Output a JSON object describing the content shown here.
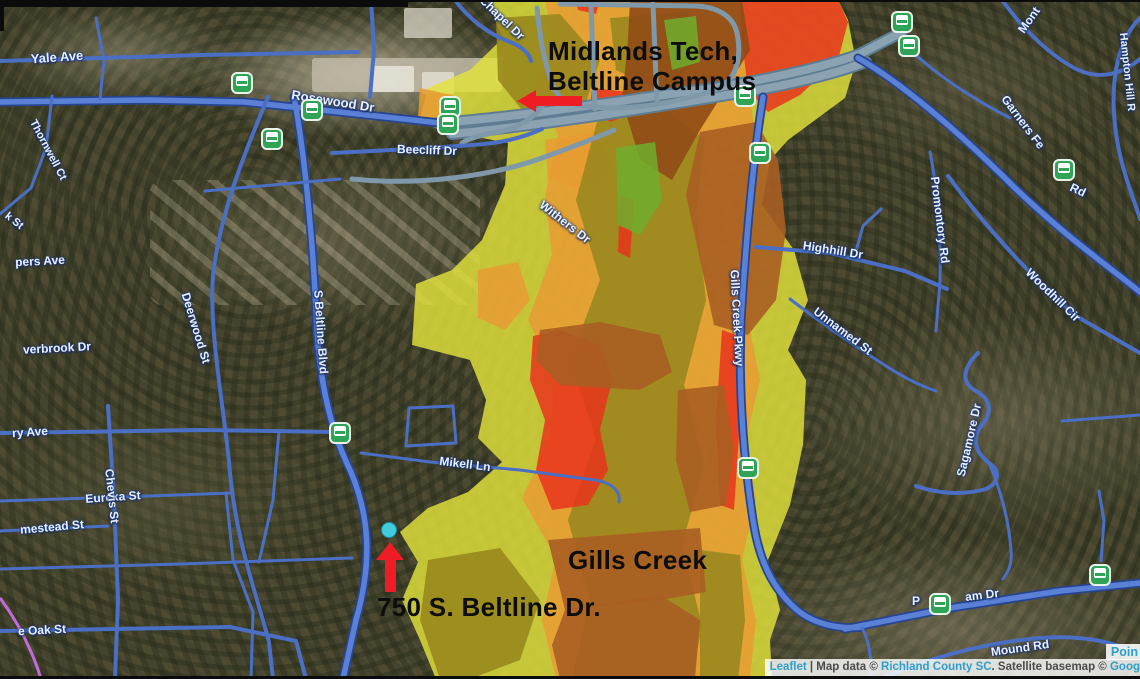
{
  "map": {
    "annotations": {
      "campus_line1": "Midlands Tech,",
      "campus_line2": "Beltline Campus",
      "address": "750 S. Beltline Dr.",
      "creek": "Gills Creek"
    },
    "street_labels": [
      {
        "text": "Yale Ave",
        "x": 57,
        "y": 57,
        "rot": -4,
        "size": 13
      },
      {
        "text": "Rosewood Dr",
        "x": 333,
        "y": 101,
        "rot": 9,
        "size": 13
      },
      {
        "text": "Thornwell Ct",
        "x": 48,
        "y": 150,
        "rot": 62,
        "size": 11
      },
      {
        "text": "Beecliff Dr",
        "x": 427,
        "y": 150,
        "rot": 2,
        "size": 12
      },
      {
        "text": "E Chapel Dr",
        "x": 498,
        "y": 14,
        "rot": 44,
        "size": 12
      },
      {
        "text": "k St",
        "x": 14,
        "y": 221,
        "rot": 38,
        "size": 11
      },
      {
        "text": "pers Ave",
        "x": 40,
        "y": 261,
        "rot": -3,
        "size": 12
      },
      {
        "text": "Withers Dr",
        "x": 565,
        "y": 222,
        "rot": 38,
        "size": 12
      },
      {
        "text": "Deerwood St",
        "x": 196,
        "y": 328,
        "rot": 73,
        "size": 12
      },
      {
        "text": "verbrook Dr",
        "x": 57,
        "y": 348,
        "rot": -3,
        "size": 12
      },
      {
        "text": "S Beltline Blvd",
        "x": 321,
        "y": 332,
        "rot": 86,
        "size": 12
      },
      {
        "text": "ry Ave",
        "x": 30,
        "y": 432,
        "rot": -4,
        "size": 12
      },
      {
        "text": "Eureka St",
        "x": 113,
        "y": 497,
        "rot": -4,
        "size": 12
      },
      {
        "text": "Chevis St",
        "x": 112,
        "y": 496,
        "rot": 84,
        "size": 12
      },
      {
        "text": "mestead St",
        "x": 52,
        "y": 527,
        "rot": -5,
        "size": 12
      },
      {
        "text": "e Oak St",
        "x": 42,
        "y": 630,
        "rot": -3,
        "size": 12
      },
      {
        "text": "Mikell Ln",
        "x": 465,
        "y": 464,
        "rot": 7,
        "size": 12
      },
      {
        "text": "Gills Creek Pkwy",
        "x": 737,
        "y": 318,
        "rot": 87,
        "size": 12
      },
      {
        "text": "Highhill Dr",
        "x": 833,
        "y": 250,
        "rot": 9,
        "size": 12
      },
      {
        "text": "Promontory Rd",
        "x": 940,
        "y": 220,
        "rot": 83,
        "size": 12
      },
      {
        "text": "Unnamed St",
        "x": 843,
        "y": 331,
        "rot": 37,
        "size": 12
      },
      {
        "text": "Woodhill Cir",
        "x": 1053,
        "y": 295,
        "rot": 44,
        "size": 12
      },
      {
        "text": "Sagamore Dr",
        "x": 969,
        "y": 440,
        "rot": -77,
        "size": 12
      },
      {
        "text": "Garners Fe",
        "x": 1023,
        "y": 122,
        "rot": 53,
        "size": 12
      },
      {
        "text": "Mont",
        "x": 1029,
        "y": 20,
        "rot": -55,
        "size": 12
      },
      {
        "text": "Hampton Hill R",
        "x": 1127,
        "y": 72,
        "rot": 84,
        "size": 11
      },
      {
        "text": "Rd",
        "x": 1078,
        "y": 190,
        "rot": 25,
        "size": 12
      },
      {
        "text": "P",
        "x": 916,
        "y": 601,
        "rot": 0,
        "size": 12
      },
      {
        "text": "am Dr",
        "x": 982,
        "y": 595,
        "rot": -7,
        "size": 12
      },
      {
        "text": "Mound Rd",
        "x": 1020,
        "y": 648,
        "rot": -8,
        "size": 12
      }
    ],
    "bus_stops": [
      {
        "x": 242,
        "y": 83
      },
      {
        "x": 312,
        "y": 110
      },
      {
        "x": 272,
        "y": 139
      },
      {
        "x": 450,
        "y": 107
      },
      {
        "x": 448,
        "y": 124
      },
      {
        "x": 902,
        "y": 22
      },
      {
        "x": 909,
        "y": 46
      },
      {
        "x": 745,
        "y": 96
      },
      {
        "x": 760,
        "y": 153
      },
      {
        "x": 1064,
        "y": 170
      },
      {
        "x": 748,
        "y": 468
      },
      {
        "x": 340,
        "y": 433
      },
      {
        "x": 940,
        "y": 604
      },
      {
        "x": 1100,
        "y": 575
      }
    ],
    "marker_dot": {
      "x": 389,
      "y": 530
    },
    "colors": {
      "flood_yellow": "#e3e33c",
      "flood_orange": "#e79b33",
      "flood_red": "#e8341c",
      "flood_olive": "#97861c",
      "flood_sienna": "#a85e22",
      "flood_sienna_dark": "#8f4a16",
      "flood_green": "#6fae2e",
      "arrow_red": "#ee1c24",
      "dot_cyan": "#41cbdd",
      "bus_green": "#2fa457"
    },
    "attribution": {
      "parts": [
        {
          "text": "Leaflet",
          "link": true
        },
        {
          "text": " | Map data © ",
          "link": false
        },
        {
          "text": "Richland County SC",
          "link": true
        },
        {
          "text": ". Satellite basemap © ",
          "link": false
        },
        {
          "text": "Goog",
          "link": true
        }
      ],
      "partial_label": "Poin"
    }
  }
}
